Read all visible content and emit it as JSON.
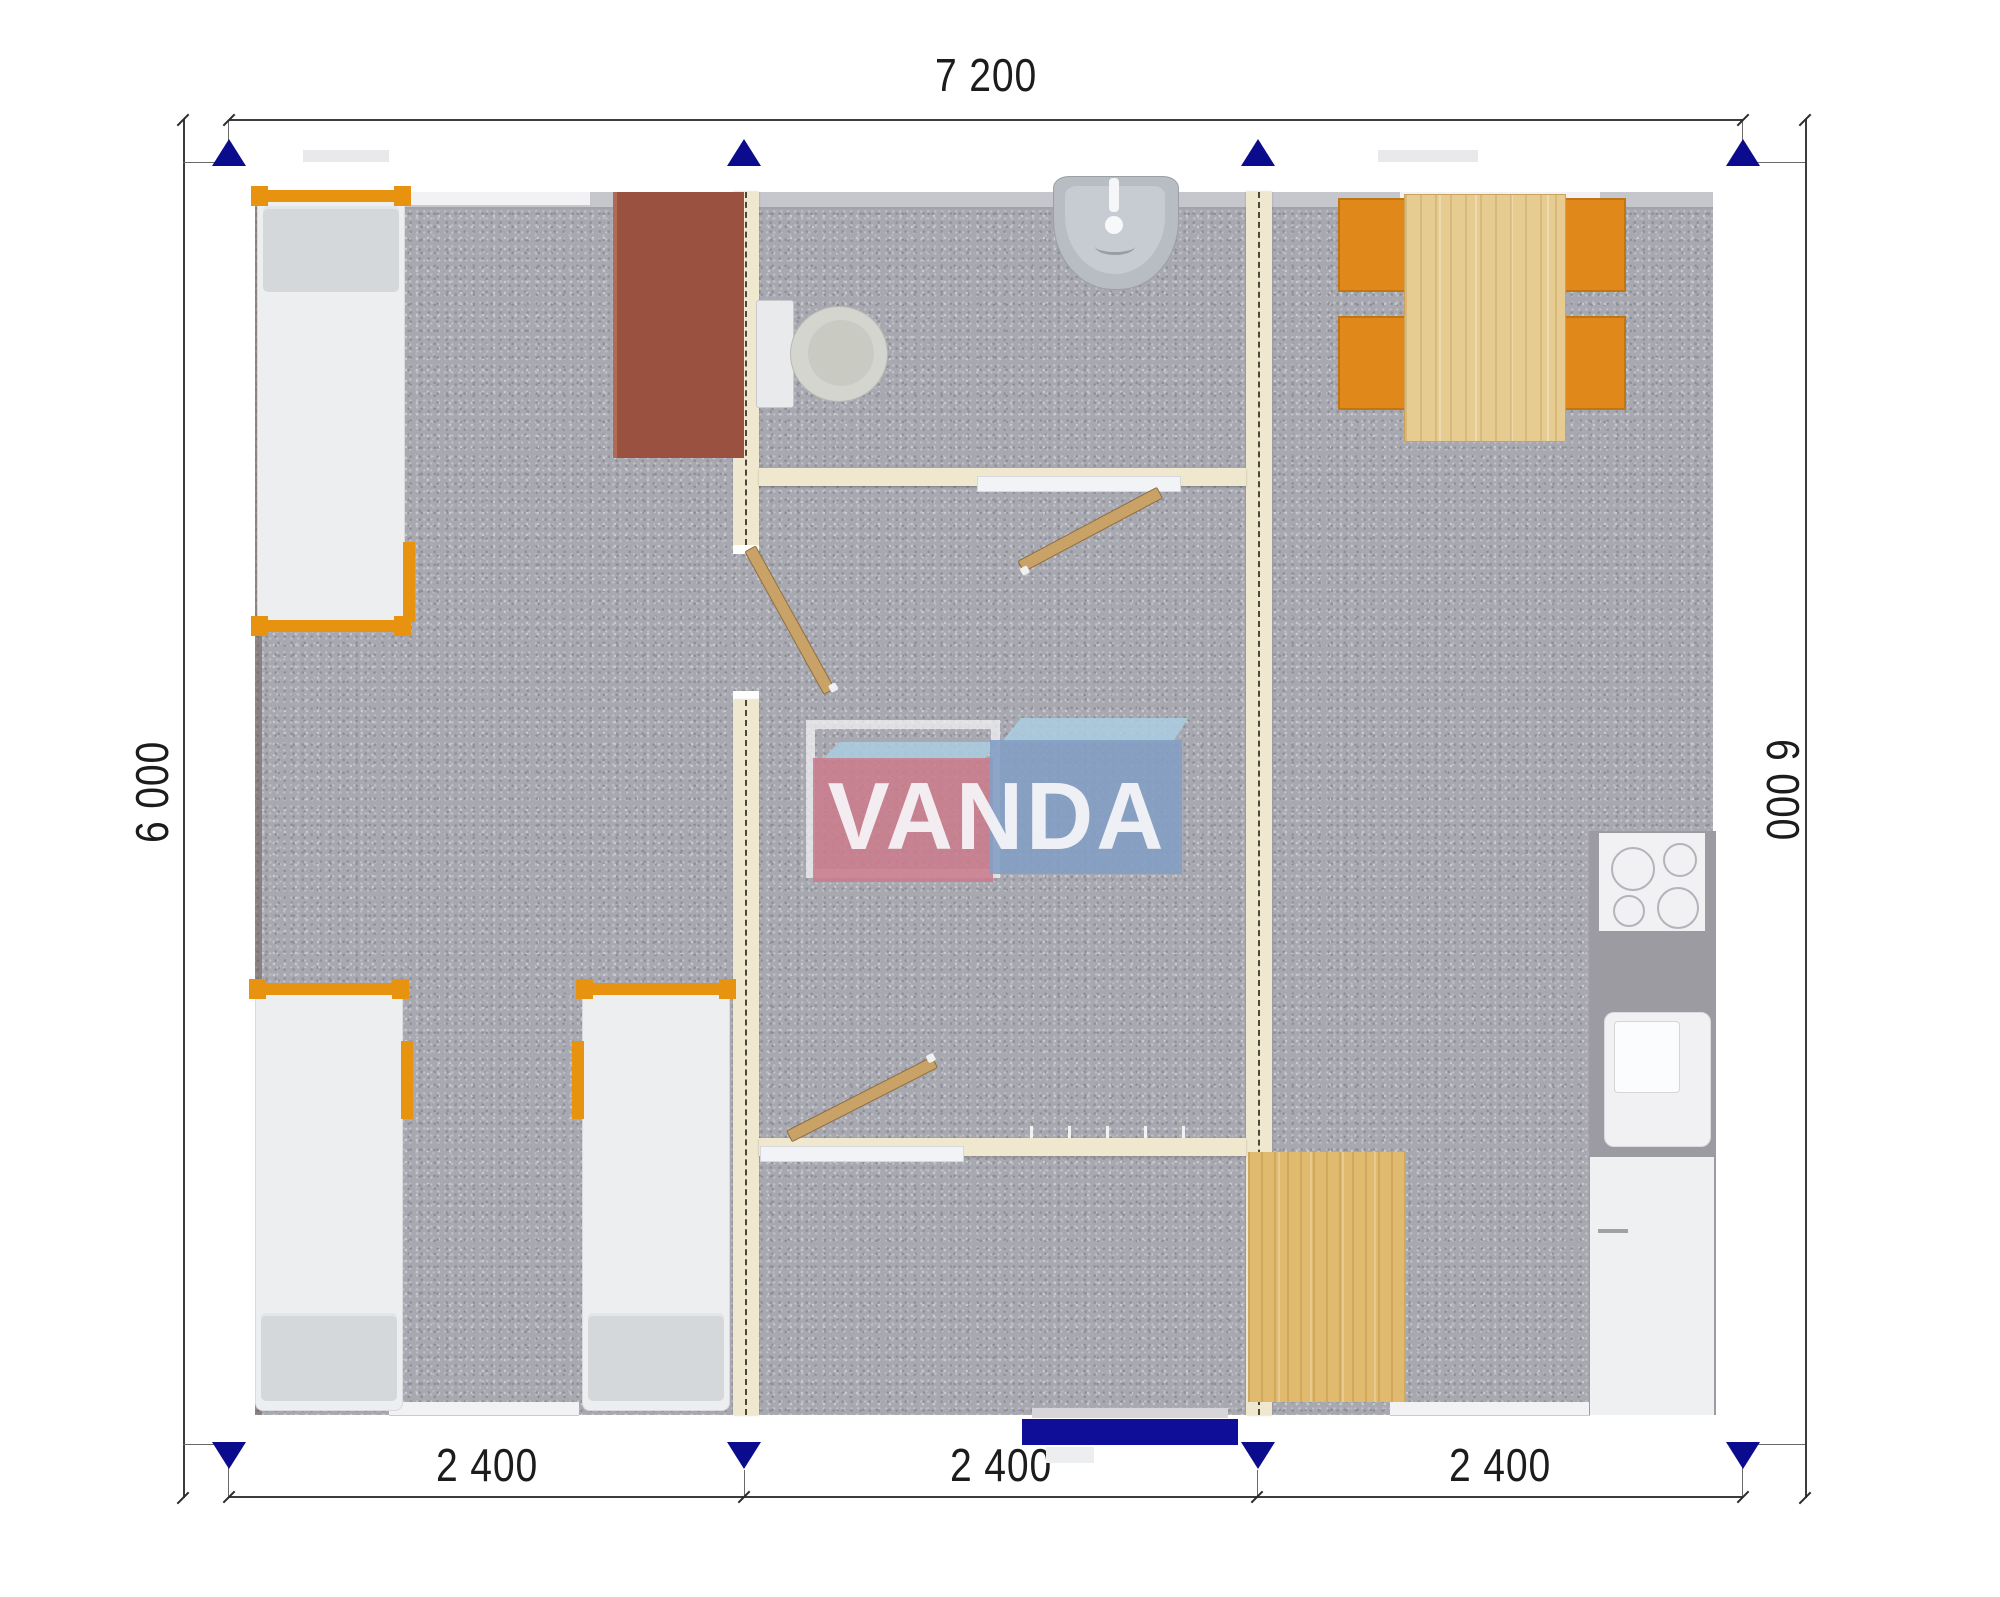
{
  "dimensions": {
    "top": "7 200",
    "left": "6 000",
    "right": "6 000",
    "bottom": [
      "2 400",
      "2 400",
      "2 400"
    ]
  },
  "logo": {
    "full": "VANDA"
  },
  "colors": {
    "wall_blue": "#1414b0",
    "arrow_blue": "#0b0b8d",
    "floor_gray": "#a8a8b1",
    "partition_cream": "#efe8ce",
    "accent_orange": "#e8930f",
    "chair_orange": "#e0891a",
    "desk_brown": "#9b5140",
    "wood_light": "#e7cc92",
    "wood_mat": "#e0ba6e",
    "counter_gray": "#9b9ba1",
    "logo_red": "#ca7c8b",
    "logo_blue": "#839fc4",
    "logo_blue_light": "#aaccdf"
  },
  "plan": {
    "modules": 3,
    "rooms": {
      "left_module": [
        "single-bed",
        "desk",
        "single-bed",
        "single-bed"
      ],
      "middle_module": [
        "bathroom-sink",
        "toilet",
        "hall-doors",
        "entrance"
      ],
      "right_module": [
        "dining-table",
        "chairs",
        "cooktop",
        "kitchen-sink",
        "cabinet",
        "wood-mat"
      ]
    }
  }
}
